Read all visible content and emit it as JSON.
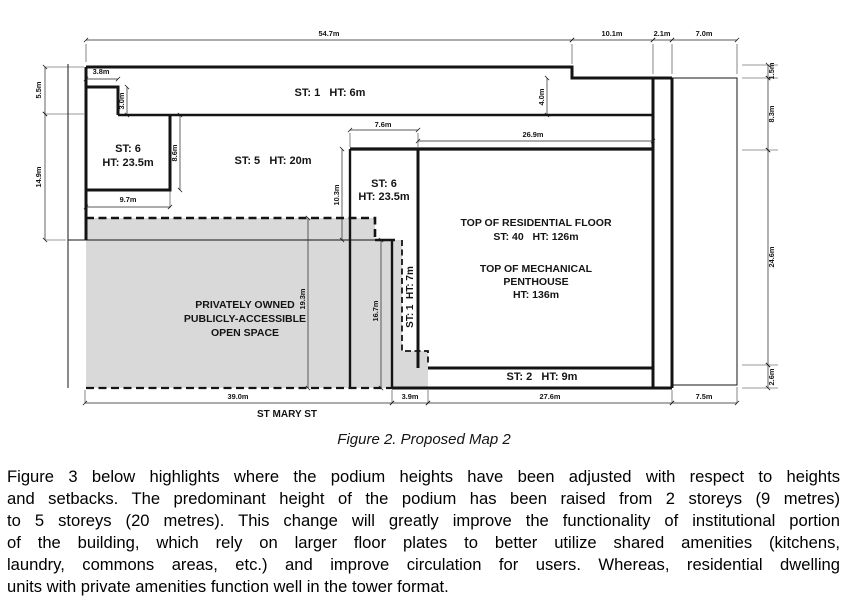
{
  "figure": {
    "caption": "Figure 2. Proposed Map 2",
    "street_label": "ST MARY ST",
    "zones": {
      "st1_top": "ST: 1   HT: 6m",
      "st6_left": {
        "l1": "ST: 6",
        "l2": "HT: 23.5m"
      },
      "st5": "ST: 5   HT: 20m",
      "st6_mid": {
        "l1": "ST: 6",
        "l2": "HT: 23.5m"
      },
      "tower": {
        "l1": "TOP OF RESIDENTIAL FLOOR",
        "l2": "ST: 40   HT: 126m",
        "l3": "TOP OF MECHANICAL",
        "l4": "PENTHOUSE",
        "l5": "HT: 136m"
      },
      "st2_base": "ST: 2   HT: 9m",
      "st1_strip": "ST: 1  HT: 7m",
      "pops": {
        "l1": "PRIVATELY OWNED",
        "l2": "PUBLICLY-ACCESSIBLE",
        "l3": "OPEN SPACE"
      }
    },
    "dims": {
      "top": [
        "54.7m",
        "10.1m",
        "2.1m",
        "7.0m"
      ],
      "bottom": [
        "39.0m",
        "3.9m",
        "27.6m",
        "7.5m"
      ],
      "left": [
        "5.5m",
        "14.9m"
      ],
      "right": [
        "1.5m",
        "8.3m",
        "24.6m",
        "2.6m"
      ],
      "inner": {
        "d38": "3.8m",
        "d30": "3.0m",
        "d40": "4.0m",
        "d76": "7.6m",
        "d269": "26.9m",
        "d103": "10.3m",
        "d86": "8.6m",
        "d97": "9.7m",
        "d193": "19.3m",
        "d167": "16.7m"
      }
    },
    "colors": {
      "open_space_fill": "#d9d9d9",
      "line": "#141414"
    }
  },
  "body": {
    "lines": [
      "Figure 3 below highlights where the podium heights have been adjusted with respect to heights",
      "and setbacks. The predominant height of the podium has been raised from 2 storeys (9 metres)",
      "to 5 storeys (20 metres). This change will greatly improve the functionality of institutional portion",
      "of the building, which rely on larger floor plates to better utilize shared amenities (kitchens,",
      "laundry, commons areas, etc.) and improve circulation for users. Whereas, residential dwelling",
      "units with private amenities function well in the tower format."
    ]
  }
}
